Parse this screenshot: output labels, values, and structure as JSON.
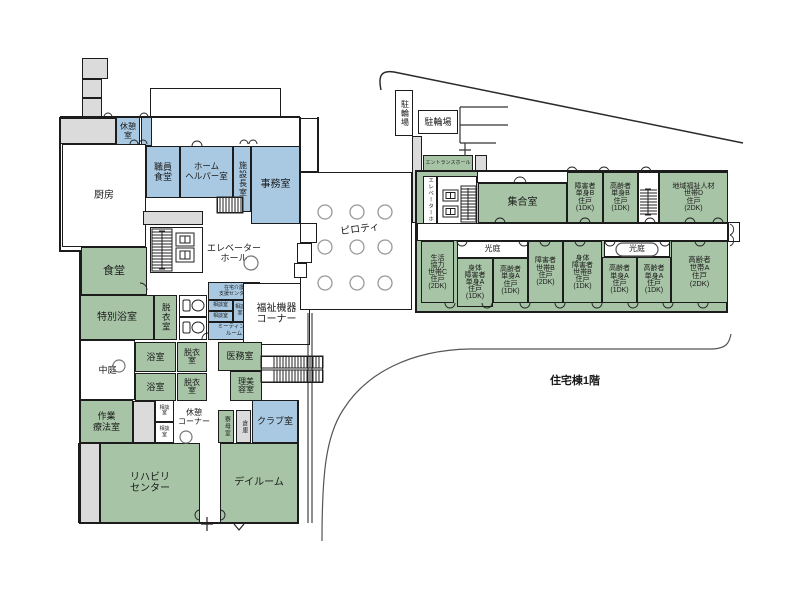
{
  "caption": "住宅棟1階",
  "colors": {
    "green": "#a7c4a6",
    "blue": "#a9c9e2",
    "gray": "#dbdbdb",
    "white": "#ffffff",
    "none": "transparent",
    "outline": "#1c1c1c"
  },
  "rooms": [
    {
      "name": "roof-box-1",
      "label": "",
      "x": 82,
      "y": 58,
      "w": 26,
      "h": 21,
      "fill": "gray"
    },
    {
      "name": "roof-box-2",
      "label": "",
      "x": 82,
      "y": 79,
      "w": 20,
      "h": 19,
      "fill": "gray"
    },
    {
      "name": "roof-box-3",
      "label": "",
      "x": 82,
      "y": 98,
      "w": 20,
      "h": 20,
      "fill": "gray"
    },
    {
      "name": "terrace",
      "label": "",
      "x": 150,
      "y": 88,
      "w": 131,
      "h": 30,
      "fill": "white"
    },
    {
      "name": "north-corridor",
      "label": "",
      "x": 60,
      "y": 118,
      "w": 56,
      "h": 26,
      "fill": "gray"
    },
    {
      "name": "room-kyukei",
      "label": "休憩\n室",
      "x": 116,
      "y": 117,
      "w": 24,
      "h": 29,
      "fill": "blue",
      "fs": 8
    },
    {
      "name": "room-blue-sliver",
      "label": "",
      "x": 141,
      "y": 117,
      "w": 11,
      "h": 29,
      "fill": "blue"
    },
    {
      "name": "room-chubo",
      "label": "厨房",
      "x": 62,
      "y": 144,
      "w": 84,
      "h": 103,
      "fill": "white",
      "fs": 10
    },
    {
      "name": "room-shokuin-shokudo",
      "label": "職員\n食堂",
      "x": 146,
      "y": 146,
      "w": 34,
      "h": 52,
      "fill": "blue",
      "fs": 9
    },
    {
      "name": "room-home-helper",
      "label": "ホーム\nヘルパー室",
      "x": 180,
      "y": 146,
      "w": 53,
      "h": 52,
      "fill": "blue",
      "fs": 8.5
    },
    {
      "name": "room-shisetsucho",
      "label": "施設長室",
      "x": 233,
      "y": 146,
      "w": 18,
      "h": 66,
      "fill": "blue",
      "fs": 8,
      "v": true
    },
    {
      "name": "room-jimushitsu",
      "label": "事務室",
      "x": 251,
      "y": 146,
      "w": 49,
      "h": 78,
      "fill": "blue",
      "fs": 10
    },
    {
      "name": "corridor-strip-1",
      "label": "",
      "x": 143,
      "y": 211,
      "w": 60,
      "h": 14,
      "fill": "gray"
    },
    {
      "name": "stairs-north-box",
      "label": "",
      "x": 217,
      "y": 197,
      "w": 26,
      "h": 16,
      "fill": "white"
    },
    {
      "name": "elevator-lobby-west",
      "label": "",
      "x": 150,
      "y": 227,
      "w": 53,
      "h": 46,
      "fill": "white"
    },
    {
      "name": "room-shokudo",
      "label": "食堂",
      "x": 81,
      "y": 247,
      "w": 66,
      "h": 48,
      "fill": "green",
      "fs": 11
    },
    {
      "name": "room-tokubetsu-yokushitsu",
      "label": "特別浴室",
      "x": 80,
      "y": 295,
      "w": 74,
      "h": 45,
      "fill": "green",
      "fs": 10
    },
    {
      "name": "room-datsuishitsu-1",
      "label": "脱衣室",
      "x": 154,
      "y": 295,
      "w": 23,
      "h": 45,
      "fill": "green",
      "fs": 8.5,
      "v": true
    },
    {
      "name": "room-toilet-1",
      "label": "",
      "x": 179,
      "y": 295,
      "w": 28,
      "h": 22,
      "fill": "white"
    },
    {
      "name": "room-toilet-2",
      "label": "",
      "x": 179,
      "y": 317,
      "w": 28,
      "h": 23,
      "fill": "white"
    },
    {
      "name": "room-zaitaku-center",
      "label": "在宅介護\n支援センター",
      "x": 208,
      "y": 282,
      "w": 52,
      "h": 18,
      "fill": "blue",
      "fs": 5,
      "lh": 1.2
    },
    {
      "name": "room-sodan-a",
      "label": "相談室",
      "x": 208,
      "y": 300,
      "w": 25,
      "h": 11,
      "fill": "blue",
      "fs": 5
    },
    {
      "name": "room-sodan-b",
      "label": "相談室",
      "x": 208,
      "y": 311,
      "w": 25,
      "h": 11,
      "fill": "blue",
      "fs": 5
    },
    {
      "name": "room-sodan-c",
      "label": "相談\n室",
      "x": 233,
      "y": 300,
      "w": 14,
      "h": 22,
      "fill": "blue",
      "fs": 5
    },
    {
      "name": "room-blue-blank",
      "label": "",
      "x": 247,
      "y": 300,
      "w": 13,
      "h": 22,
      "fill": "blue"
    },
    {
      "name": "room-meeting",
      "label": "ミーティング\nルーム",
      "x": 208,
      "y": 322,
      "w": 52,
      "h": 18,
      "fill": "blue",
      "fs": 5.5,
      "lh": 1.2
    },
    {
      "name": "room-fukushi-kiki",
      "label": "福祉機器\nコーナー",
      "x": 243,
      "y": 283,
      "w": 67,
      "h": 62,
      "fill": "white",
      "fs": 10
    },
    {
      "name": "room-nakaniwa",
      "label": "中庭",
      "x": 80,
      "y": 340,
      "w": 55,
      "h": 60,
      "fill": "white",
      "fs": 9
    },
    {
      "name": "room-yokushitsu-1",
      "label": "浴室",
      "x": 135,
      "y": 342,
      "w": 41,
      "h": 30,
      "fill": "green",
      "fs": 9
    },
    {
      "name": "room-datsui-2",
      "label": "脱衣\n室",
      "x": 177,
      "y": 342,
      "w": 30,
      "h": 30,
      "fill": "green",
      "fs": 8,
      "lh": 1.0
    },
    {
      "name": "room-yokushitsu-2",
      "label": "浴室",
      "x": 135,
      "y": 373,
      "w": 41,
      "h": 28,
      "fill": "green",
      "fs": 9
    },
    {
      "name": "room-datsui-3",
      "label": "脱衣\n室",
      "x": 177,
      "y": 373,
      "w": 30,
      "h": 28,
      "fill": "green",
      "fs": 8,
      "lh": 1.0
    },
    {
      "name": "room-imushitsu",
      "label": "医務室",
      "x": 218,
      "y": 342,
      "w": 44,
      "h": 29,
      "fill": "green",
      "fs": 9
    },
    {
      "name": "room-ribiyou",
      "label": "理美\n容室",
      "x": 230,
      "y": 371,
      "w": 32,
      "h": 30,
      "fill": "green",
      "fs": 8,
      "lh": 1.0
    },
    {
      "name": "stairs-south-box",
      "label": "",
      "x": 261,
      "y": 356,
      "w": 62,
      "h": 27,
      "fill": "white"
    },
    {
      "name": "room-sagyou",
      "label": "作業\n療法室",
      "x": 80,
      "y": 400,
      "w": 53,
      "h": 43,
      "fill": "green",
      "fs": 9
    },
    {
      "name": "gray-strip-2",
      "label": "",
      "x": 133,
      "y": 401,
      "w": 22,
      "h": 42,
      "fill": "gray"
    },
    {
      "name": "room-sodan-d",
      "label": "相談\n室",
      "x": 155,
      "y": 400,
      "w": 19,
      "h": 22,
      "fill": "white",
      "fs": 5,
      "lh": 1.1
    },
    {
      "name": "room-sodan-e",
      "label": "相談\n室",
      "x": 155,
      "y": 422,
      "w": 19,
      "h": 21,
      "fill": "white",
      "fs": 5,
      "lh": 1.1
    },
    {
      "name": "room-ryobo",
      "label": "寮母室",
      "x": 218,
      "y": 410,
      "w": 16,
      "h": 33,
      "fill": "green",
      "fs": 6,
      "v": true
    },
    {
      "name": "room-souko",
      "label": "倉庫",
      "x": 236,
      "y": 410,
      "w": 15,
      "h": 33,
      "fill": "gray",
      "fs": 6,
      "v": true
    },
    {
      "name": "room-club",
      "label": "クラブ室",
      "x": 252,
      "y": 400,
      "w": 46,
      "h": 43,
      "fill": "blue",
      "fs": 9
    },
    {
      "name": "gray-strip-3",
      "label": "",
      "x": 78,
      "y": 443,
      "w": 22,
      "h": 80,
      "fill": "gray"
    },
    {
      "name": "room-rehab",
      "label": "リハビリ\nセンター",
      "x": 100,
      "y": 443,
      "w": 100,
      "h": 80,
      "fill": "green",
      "fs": 10
    },
    {
      "name": "room-dayroom",
      "label": "デイルーム",
      "x": 220,
      "y": 443,
      "w": 78,
      "h": 80,
      "fill": "green",
      "fs": 10
    },
    {
      "name": "corridor-bump",
      "label": "",
      "x": 300,
      "y": 118,
      "w": 18,
      "h": 54,
      "fill": "white"
    },
    {
      "name": "piloti",
      "label": "",
      "x": 300,
      "y": 172,
      "w": 112,
      "h": 138,
      "fill": "white"
    },
    {
      "name": "step-box-1",
      "label": "",
      "x": 300,
      "y": 223,
      "w": 17,
      "h": 20,
      "fill": "white"
    },
    {
      "name": "step-box-2",
      "label": "",
      "x": 297,
      "y": 243,
      "w": 15,
      "h": 20,
      "fill": "white"
    },
    {
      "name": "step-box-3",
      "label": "",
      "x": 294,
      "y": 263,
      "w": 13,
      "h": 15,
      "fill": "white"
    },
    {
      "name": "bike-parking-vertical",
      "label": "駐輪場",
      "x": 395,
      "y": 90,
      "w": 18,
      "h": 46,
      "fill": "white",
      "fs": 8,
      "v": true
    },
    {
      "name": "bike-parking",
      "label": "駐輪場",
      "x": 418,
      "y": 110,
      "w": 40,
      "h": 24,
      "fill": "white",
      "fs": 9
    },
    {
      "name": "entrance-walkway",
      "label": "",
      "x": 412,
      "y": 136,
      "w": 10,
      "h": 87,
      "fill": "gray"
    },
    {
      "name": "entrance-hall",
      "label": "エントランスホール",
      "x": 423,
      "y": 155,
      "w": 50,
      "h": 17,
      "fill": "green",
      "fs": 5
    },
    {
      "name": "entrance-gray",
      "label": "",
      "x": 475,
      "y": 155,
      "w": 12,
      "h": 17,
      "fill": "gray"
    },
    {
      "name": "entrance-strip",
      "label": "",
      "x": 423,
      "y": 172,
      "w": 64,
      "h": 10,
      "fill": "gray"
    },
    {
      "name": "wing-outline",
      "label": "",
      "x": 415,
      "y": 170,
      "w": 313,
      "h": 143,
      "fill": "green",
      "bw": 2
    },
    {
      "name": "wing-top-gap",
      "label": "",
      "x": 477,
      "y": 171,
      "w": 91,
      "h": 12,
      "fill": "white"
    },
    {
      "name": "wing-elevator-hall-label",
      "label": "エレベーターホール",
      "x": 423,
      "y": 176,
      "w": 14,
      "h": 61,
      "fill": "white",
      "fs": 5.5,
      "v": true
    },
    {
      "name": "wing-elevator-lobby",
      "label": "",
      "x": 437,
      "y": 176,
      "w": 40,
      "h": 61,
      "fill": "white"
    },
    {
      "name": "room-shugoshitsu",
      "label": "集合室",
      "x": 478,
      "y": 183,
      "w": 89,
      "h": 40,
      "fill": "green",
      "fs": 10
    },
    {
      "name": "unit-shogaisha-tanshin-b",
      "label": "障害者\n単身B\n住戸\n(1DK)",
      "x": 567,
      "y": 172,
      "w": 36,
      "h": 51,
      "fill": "green",
      "fs": 7,
      "lh": 1.05
    },
    {
      "name": "unit-korei-tanshin-b",
      "label": "高齢者\n単身B\n住戸\n(1DK)",
      "x": 603,
      "y": 172,
      "w": 35,
      "h": 51,
      "fill": "green",
      "fs": 7,
      "lh": 1.05
    },
    {
      "name": "wing-stairs-box",
      "label": "",
      "x": 638,
      "y": 172,
      "w": 21,
      "h": 51,
      "fill": "white"
    },
    {
      "name": "unit-chiiki-fukushi-d",
      "label": "地域福祉人材\n世帯D\n住戸\n(2DK)",
      "x": 659,
      "y": 172,
      "w": 69,
      "h": 51,
      "fill": "green",
      "fs": 7,
      "lh": 1.05
    },
    {
      "name": "wing-corridor",
      "label": "",
      "x": 417,
      "y": 223,
      "w": 311,
      "h": 18,
      "fill": "white"
    },
    {
      "name": "wing-exit-bump",
      "label": "",
      "x": 728,
      "y": 222,
      "w": 12,
      "h": 20,
      "fill": "white"
    },
    {
      "name": "unit-seikatsu-kyoryoku-c",
      "label": "生活\n協力\n世帯C\n住戸\n(2DK)",
      "x": 421,
      "y": 241,
      "w": 33,
      "h": 62,
      "fill": "green",
      "fs": 7,
      "lh": 1.0
    },
    {
      "name": "kotei-west",
      "label": "光庭",
      "x": 457,
      "y": 241,
      "w": 71,
      "h": 17,
      "fill": "white",
      "fs": 8
    },
    {
      "name": "unit-shintai-tanshin-a",
      "label": "身体\n障害者\n単身A\n住戸\n(1DK)",
      "x": 457,
      "y": 258,
      "w": 36,
      "h": 49,
      "fill": "green",
      "fs": 7,
      "lh": 1.0
    },
    {
      "name": "unit-korei-tanshin-a1",
      "label": "高齢者\n単身A\n住戸\n(1DK)",
      "x": 493,
      "y": 258,
      "w": 35,
      "h": 45,
      "fill": "green",
      "fs": 7,
      "lh": 1.05
    },
    {
      "name": "unit-shogaisha-setai-b",
      "label": "障害者\n世帯B\n住戸\n(2DK)",
      "x": 528,
      "y": 241,
      "w": 35,
      "h": 62,
      "fill": "green",
      "fs": 7,
      "lh": 1.05
    },
    {
      "name": "unit-shintai-setai-b",
      "label": "身体\n障害者\n世帯B\n住戸\n(1DK)",
      "x": 563,
      "y": 241,
      "w": 39,
      "h": 62,
      "fill": "green",
      "fs": 7,
      "lh": 1.0
    },
    {
      "name": "kotei-east",
      "label": "光庭",
      "x": 604,
      "y": 241,
      "w": 66,
      "h": 16,
      "fill": "white",
      "fs": 8
    },
    {
      "name": "unit-korei-tanshin-a2",
      "label": "高齢者\n単身A\n住戸\n(1DK)",
      "x": 602,
      "y": 257,
      "w": 35,
      "h": 46,
      "fill": "green",
      "fs": 7,
      "lh": 1.05
    },
    {
      "name": "unit-korei-tanshin-a3",
      "label": "高齢者\n単身A\n住戸\n(1DK)",
      "x": 637,
      "y": 257,
      "w": 34,
      "h": 46,
      "fill": "green",
      "fs": 7,
      "lh": 1.05
    },
    {
      "name": "unit-korei-setai-a",
      "label": "高齢者\n世帯A\n住戸\n(2DK)",
      "x": 671,
      "y": 241,
      "w": 57,
      "h": 62,
      "fill": "green",
      "fs": 7.5,
      "lh": 1.1
    },
    {
      "name": "label-elevator-hall-west",
      "label": "エレベーター\nホール",
      "x": 203,
      "y": 240,
      "w": 62,
      "h": 26,
      "fill": "none",
      "fs": 9
    },
    {
      "name": "label-kyukei-corner",
      "label": "休憩\nコーナー",
      "x": 172,
      "y": 405,
      "w": 44,
      "h": 26,
      "fill": "none",
      "fs": 8
    },
    {
      "name": "label-piloti",
      "label": "ピロティ",
      "x": 330,
      "y": 222,
      "w": 60,
      "h": 16,
      "fill": "none",
      "fs": 10,
      "rot": -7
    },
    {
      "name": "label-jutakuto-1f",
      "label": "住宅棟1階",
      "x": 520,
      "y": 372,
      "w": 110,
      "h": 18,
      "fill": "none",
      "fs": 11,
      "bold": true
    }
  ]
}
